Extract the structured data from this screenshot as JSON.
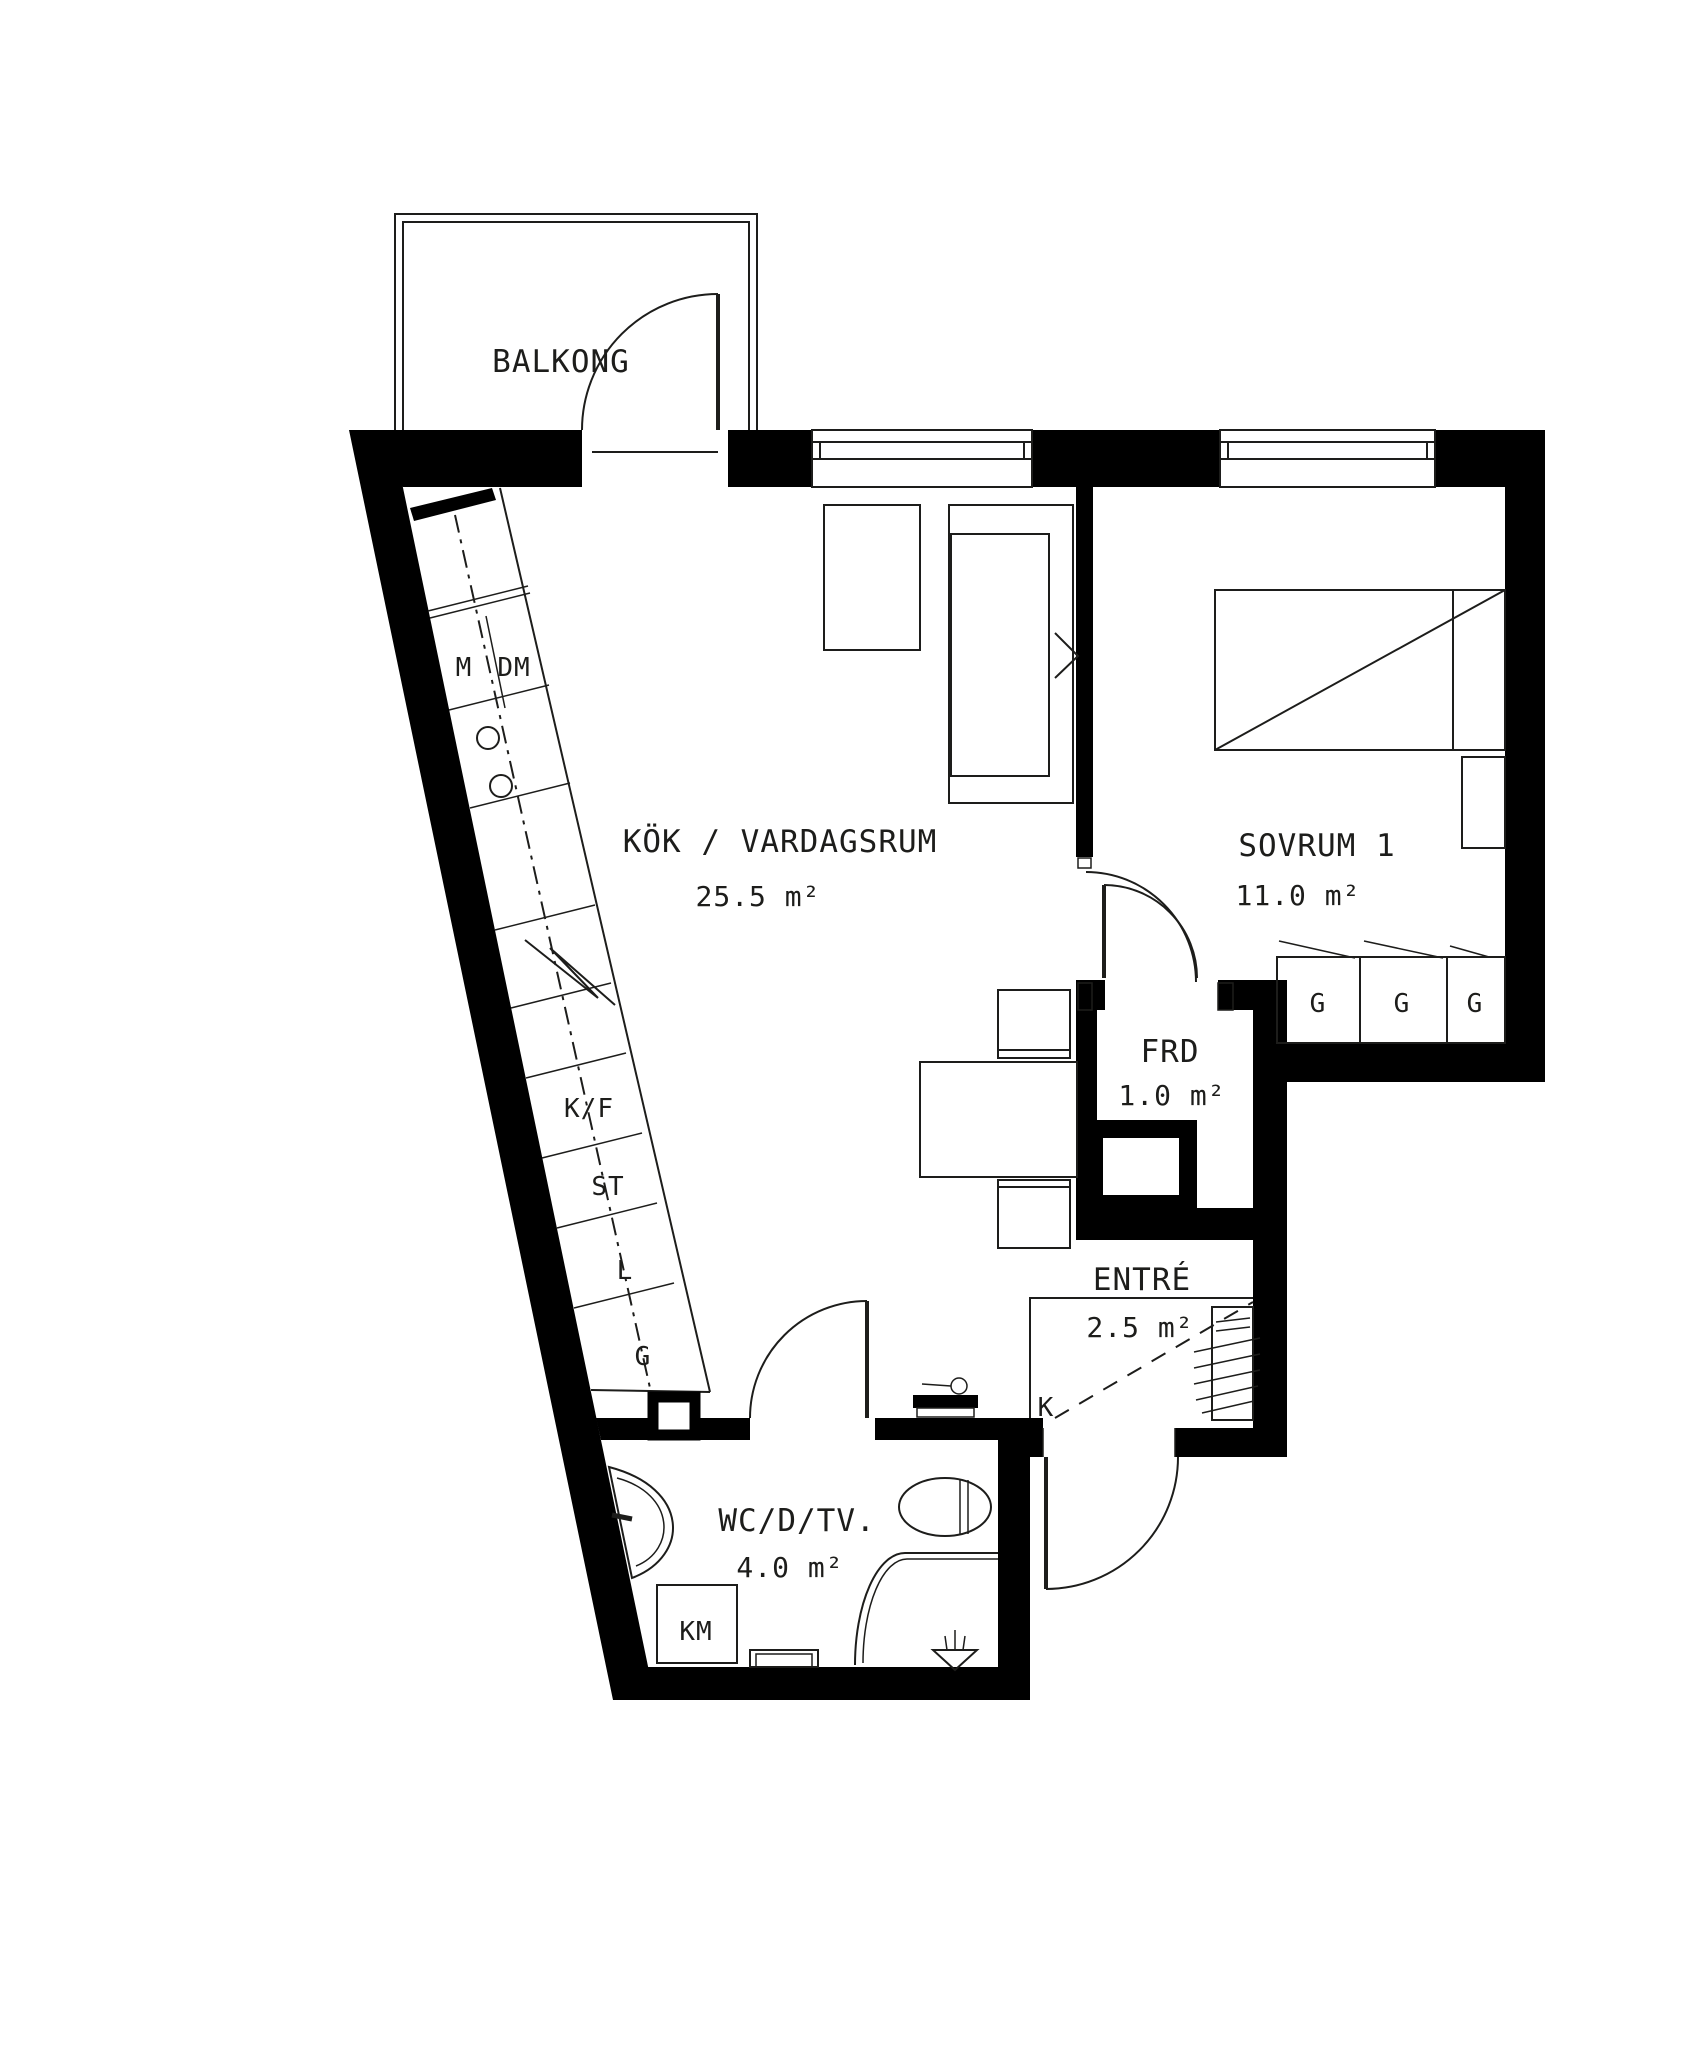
{
  "document": {
    "type": "apartment floor plan",
    "style": "Swedish architectural drawing"
  },
  "colors": {
    "wall": "#000000",
    "line": "#1d1d1b",
    "background": "#ffffff"
  },
  "rooms": {
    "balcony": {
      "name": "BALKONG"
    },
    "living": {
      "name": "KÖK / VARDAGSRUM",
      "area": "25.5 m²"
    },
    "bedroom": {
      "name": "SOVRUM 1",
      "area": "11.0 m²"
    },
    "storage": {
      "name": "FRD",
      "area": "1.0 m²"
    },
    "entrance": {
      "name": "ENTRÉ",
      "area": "2.5 m²"
    },
    "bathroom": {
      "name": "WC/D/TV.",
      "area": "4.0 m²"
    }
  },
  "kitchen_labels": {
    "micro": "M",
    "dishwasher": "DM",
    "fridge_freezer": "K/F",
    "tall_cabinet": "ST",
    "linen_cabinet": "L",
    "wardrobe": "G"
  },
  "bedroom_wardrobe_labels": [
    "G",
    "G",
    "G"
  ],
  "bathroom_labels": {
    "washing_machine": "KM"
  },
  "entrance_labels": {
    "k_mark": "K"
  }
}
